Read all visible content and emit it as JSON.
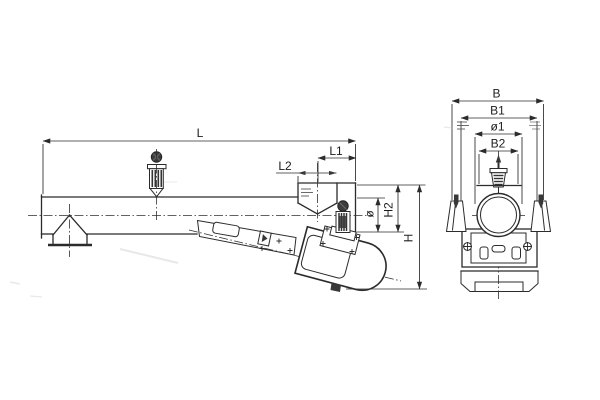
{
  "drawing": {
    "kind": "technical-drawing",
    "ink_color": "#2b2b2b",
    "background_color": "#ffffff",
    "dimensions": {
      "L": "L",
      "L1": "L1",
      "L2": "L2",
      "phi": "ø",
      "H2": "H2",
      "H": "H",
      "B": "B",
      "B1": "B1",
      "phi1": "ø1",
      "B2": "B2"
    }
  }
}
